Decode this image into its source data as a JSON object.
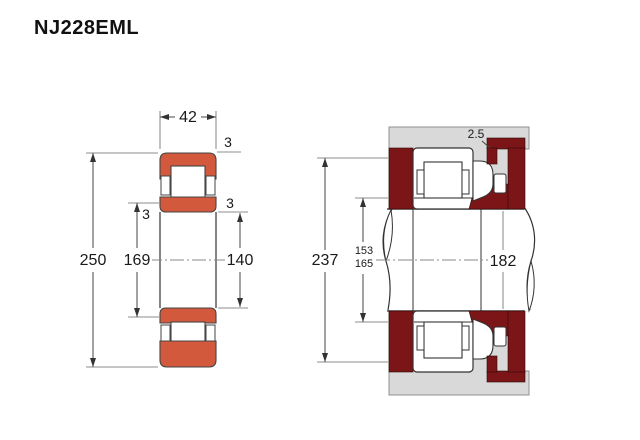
{
  "title": "NJ228EML",
  "colors": {
    "ring_orange": "#d2593c",
    "steel_dark_red": "#7b1517",
    "housing_gray": "#d9d9d9",
    "outline": "#333333"
  },
  "left_view": {
    "label": "bearing-cross-section",
    "dims": {
      "width": "42",
      "outer_diameter": "250",
      "raceway_diameter": "169",
      "bore_diameter": "140",
      "chamfer_outer": "3",
      "chamfer_left": "3",
      "chamfer_right": "3"
    }
  },
  "right_view": {
    "label": "mounted-arrangement",
    "dims": {
      "housing_abutment_diameter": "237",
      "shaft_abutment_min": "153",
      "shaft_abutment_max": "165",
      "shaft_diameter": "182",
      "recess": "2.5"
    }
  }
}
